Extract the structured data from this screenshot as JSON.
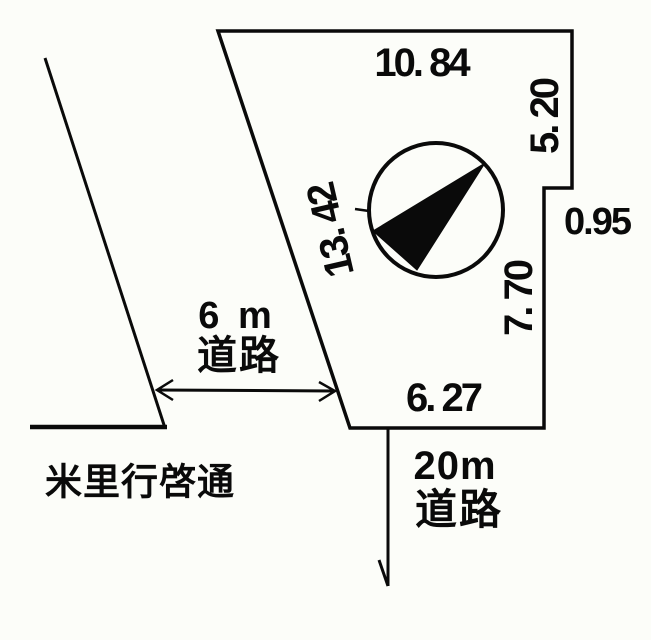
{
  "figure": {
    "type": "land-plot-survey-diagram",
    "background_color": "#fcfdf9",
    "line_color": "#0a0a0a"
  },
  "parcel": {
    "dimensions": {
      "top": "10. 84",
      "right_upper": "5. 20",
      "step": "0.95",
      "right_lower": "7. 70",
      "bottom": "6. 27",
      "diagonal": "13. 42"
    }
  },
  "roads": {
    "west": {
      "width_label": "6 m",
      "type_label": "道路"
    },
    "south": {
      "width_label": "20m",
      "type_label": "道路"
    },
    "street_name": "米里行啓通"
  },
  "compass": {
    "icon": "north-arrow-icon",
    "needle_direction": "northeast"
  }
}
